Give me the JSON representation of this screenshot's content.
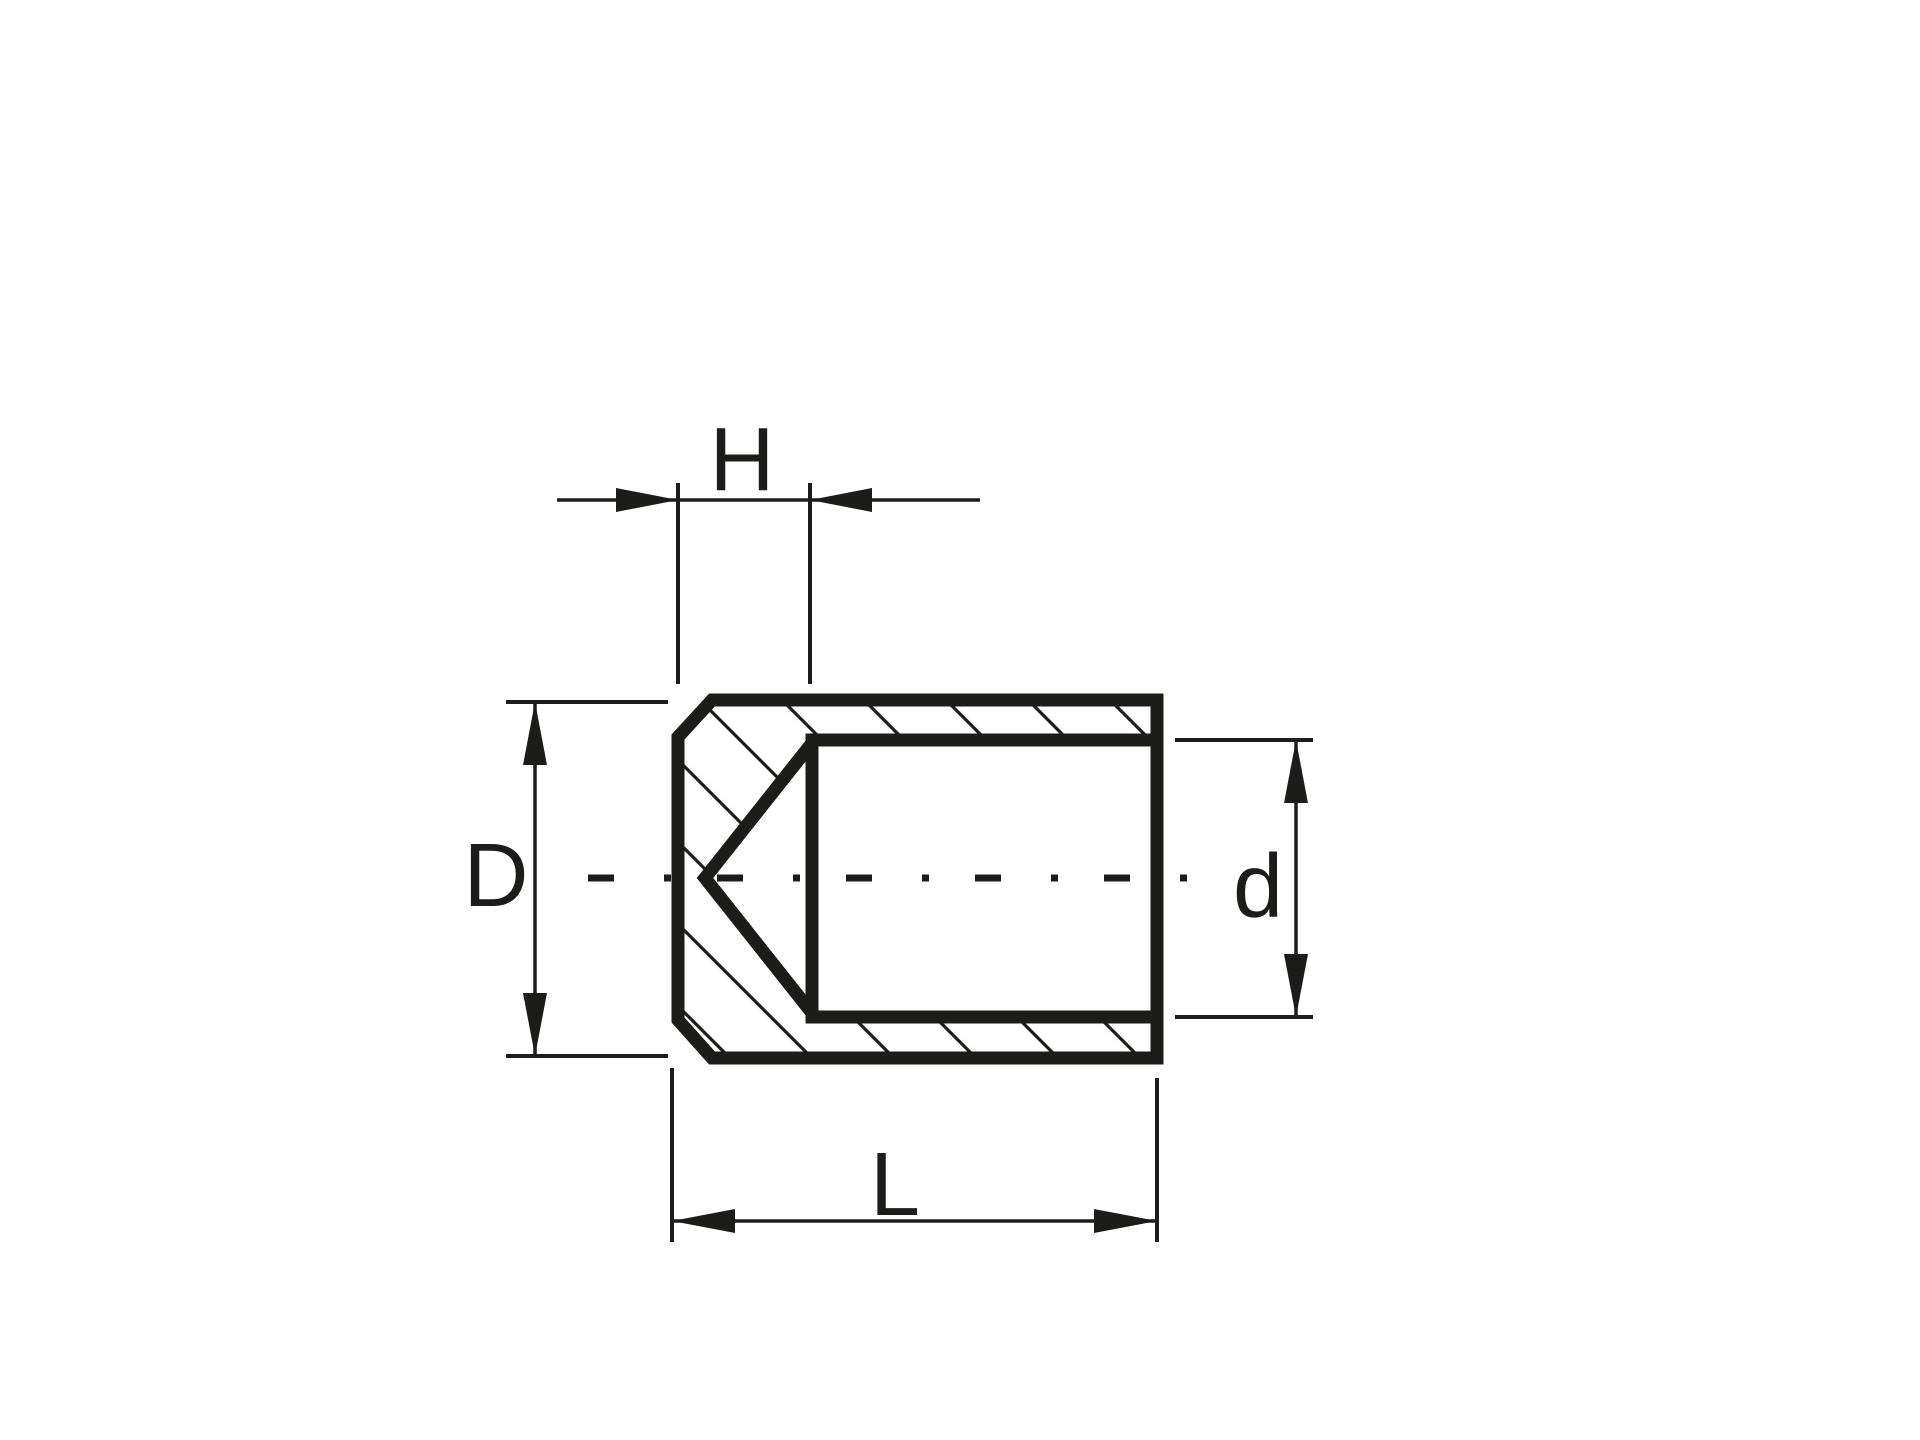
{
  "drawing": {
    "background": "#ffffff",
    "ink": "#1c1c1a",
    "labels": {
      "top_dimension": "H",
      "left_dimension": "D",
      "right_dimension": "d",
      "bottom_dimension": "L"
    }
  }
}
